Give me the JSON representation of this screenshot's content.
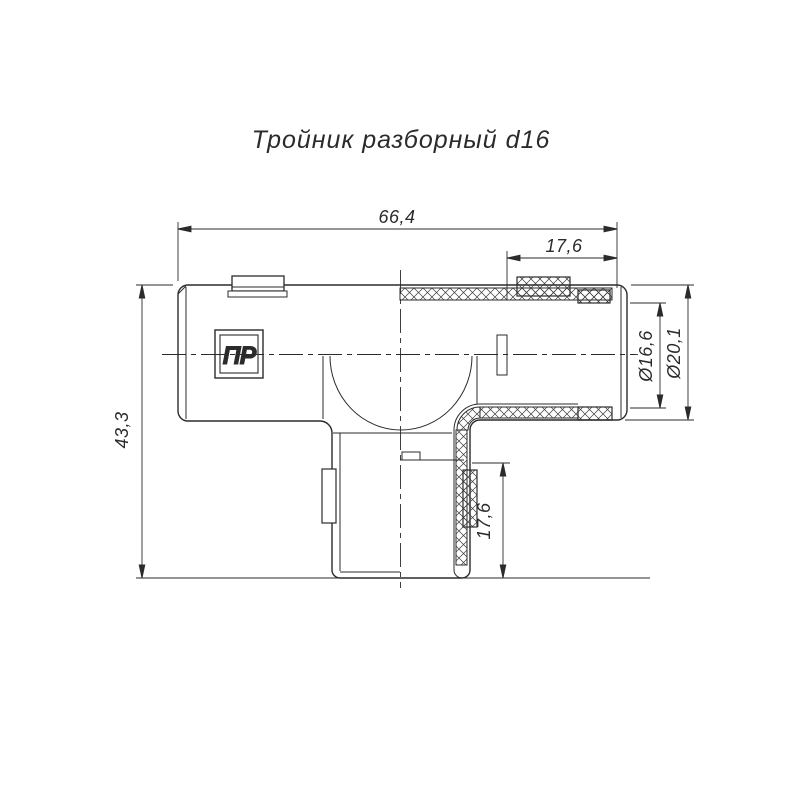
{
  "title": "Тройник разборный d16",
  "part_label": "ПР",
  "dimensions": {
    "overall_width": "66,4",
    "right_port_depth": "17,6",
    "overall_height": "43,3",
    "bottom_port_depth": "17,6",
    "inner_diameter": "Ø16,6",
    "outer_diameter": "Ø20,1"
  },
  "colors": {
    "line": "#2b2b2b",
    "background": "#ffffff"
  }
}
